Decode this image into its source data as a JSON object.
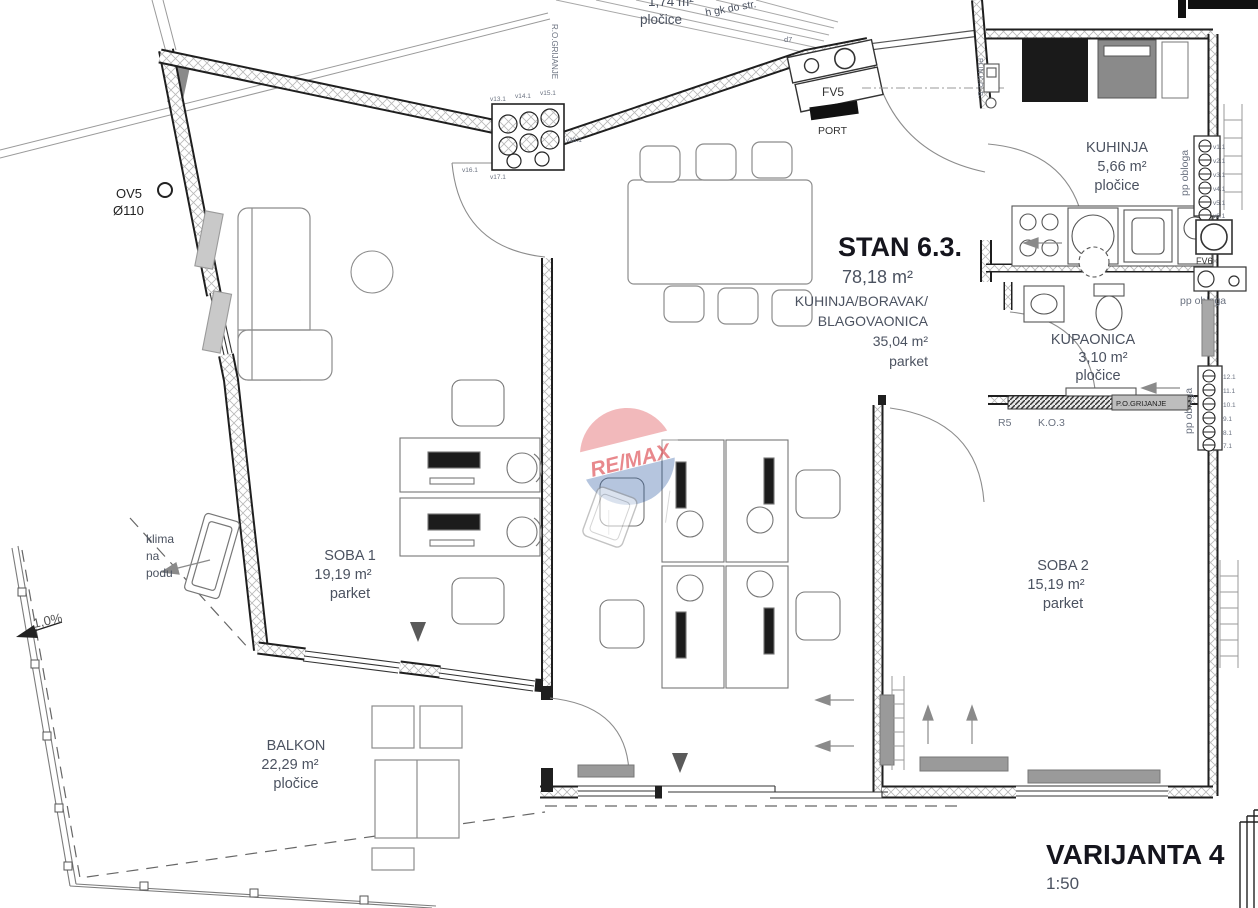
{
  "title_block": {
    "variant": "VARIJANTA 4",
    "scale": "1:50"
  },
  "apartment": {
    "name": "STAN 6.3.",
    "area": "78,18 m²"
  },
  "rooms": {
    "living": {
      "name_line1": "KUHINJA/BORAVAK/",
      "name_line2": "BLAGOVAONICA",
      "area": "35,04 m²",
      "floor": "parket"
    },
    "kitchen": {
      "name": "KUHINJA",
      "area": "5,66 m²",
      "floor": "pločice"
    },
    "bathroom": {
      "name": "KUPAONICA",
      "area": "3,10 m²",
      "floor": "pločice"
    },
    "room1": {
      "name": "SOBA 1",
      "area": "19,19 m²",
      "floor": "parket"
    },
    "room2": {
      "name": "SOBA 2",
      "area": "15,19 m²",
      "floor": "parket"
    },
    "balcony": {
      "name": "BALKON",
      "area": "22,29 m²",
      "floor": "pločice"
    },
    "loggia_top": {
      "area": "1,74 m²",
      "floor": "pločice"
    }
  },
  "annotations": {
    "ov5": "OV5",
    "ov5_d": "Ø110",
    "klima_1": "klima",
    "klima_2": "na",
    "klima_3": "podu",
    "slope": "1,0%",
    "fv5": "FV5",
    "port": "PORT",
    "fv6": "FV6",
    "ro_grijanje": "R.O.GRIJANJE",
    "po_grijanje": "P.O.GRIJANJE",
    "plin": "PLIN K.O. B.",
    "r5": "R5",
    "ko3": "K.O.3",
    "pp_obloga_1": "pp obloga",
    "pp_obloga_2": "pp obloga",
    "pp_obloga_3": "pp obloga",
    "h_gk": "h gk do str.",
    "d7": "d7"
  },
  "shafts": {
    "top": {
      "valves": [
        "v13.1",
        "v14.1",
        "v15.1",
        "v16.1",
        "v17.1",
        "v18.1"
      ]
    },
    "kitchen_right": {
      "valves": [
        "v1.1",
        "v2.1",
        "v3.1",
        "v4.1",
        "v5.1",
        "v6.1"
      ]
    },
    "bath_right": {
      "valves": [
        "12.1",
        "11.1",
        "10.1",
        "9.1",
        "8.1",
        "7.1"
      ]
    }
  },
  "watermark": {
    "brand": "RE/MAX",
    "red": "#d7282f",
    "blue": "#1b4f9c"
  },
  "colors": {
    "wall": "#1f1f1f",
    "hatch": "#b8b8b8",
    "furniture": "#8c8c8c",
    "label": "#4b5260",
    "title": "#15151d"
  }
}
